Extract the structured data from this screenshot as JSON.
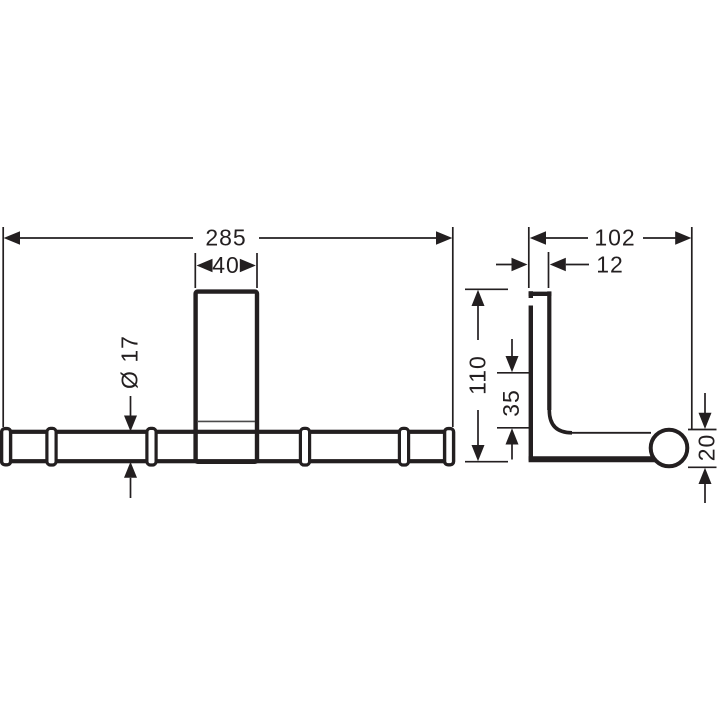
{
  "colors": {
    "line": "#231f20",
    "thin_line": "#4b4b4b",
    "background": "#ffffff"
  },
  "dimensions": {
    "front": {
      "overall_width": "285",
      "plate_width": "40",
      "bar_diameter": "Ø 17"
    },
    "side": {
      "overall_depth": "102",
      "plate_thickness": "12",
      "overall_height": "110",
      "bar_center_offset": "35",
      "end_cap_diameter": "20"
    }
  }
}
